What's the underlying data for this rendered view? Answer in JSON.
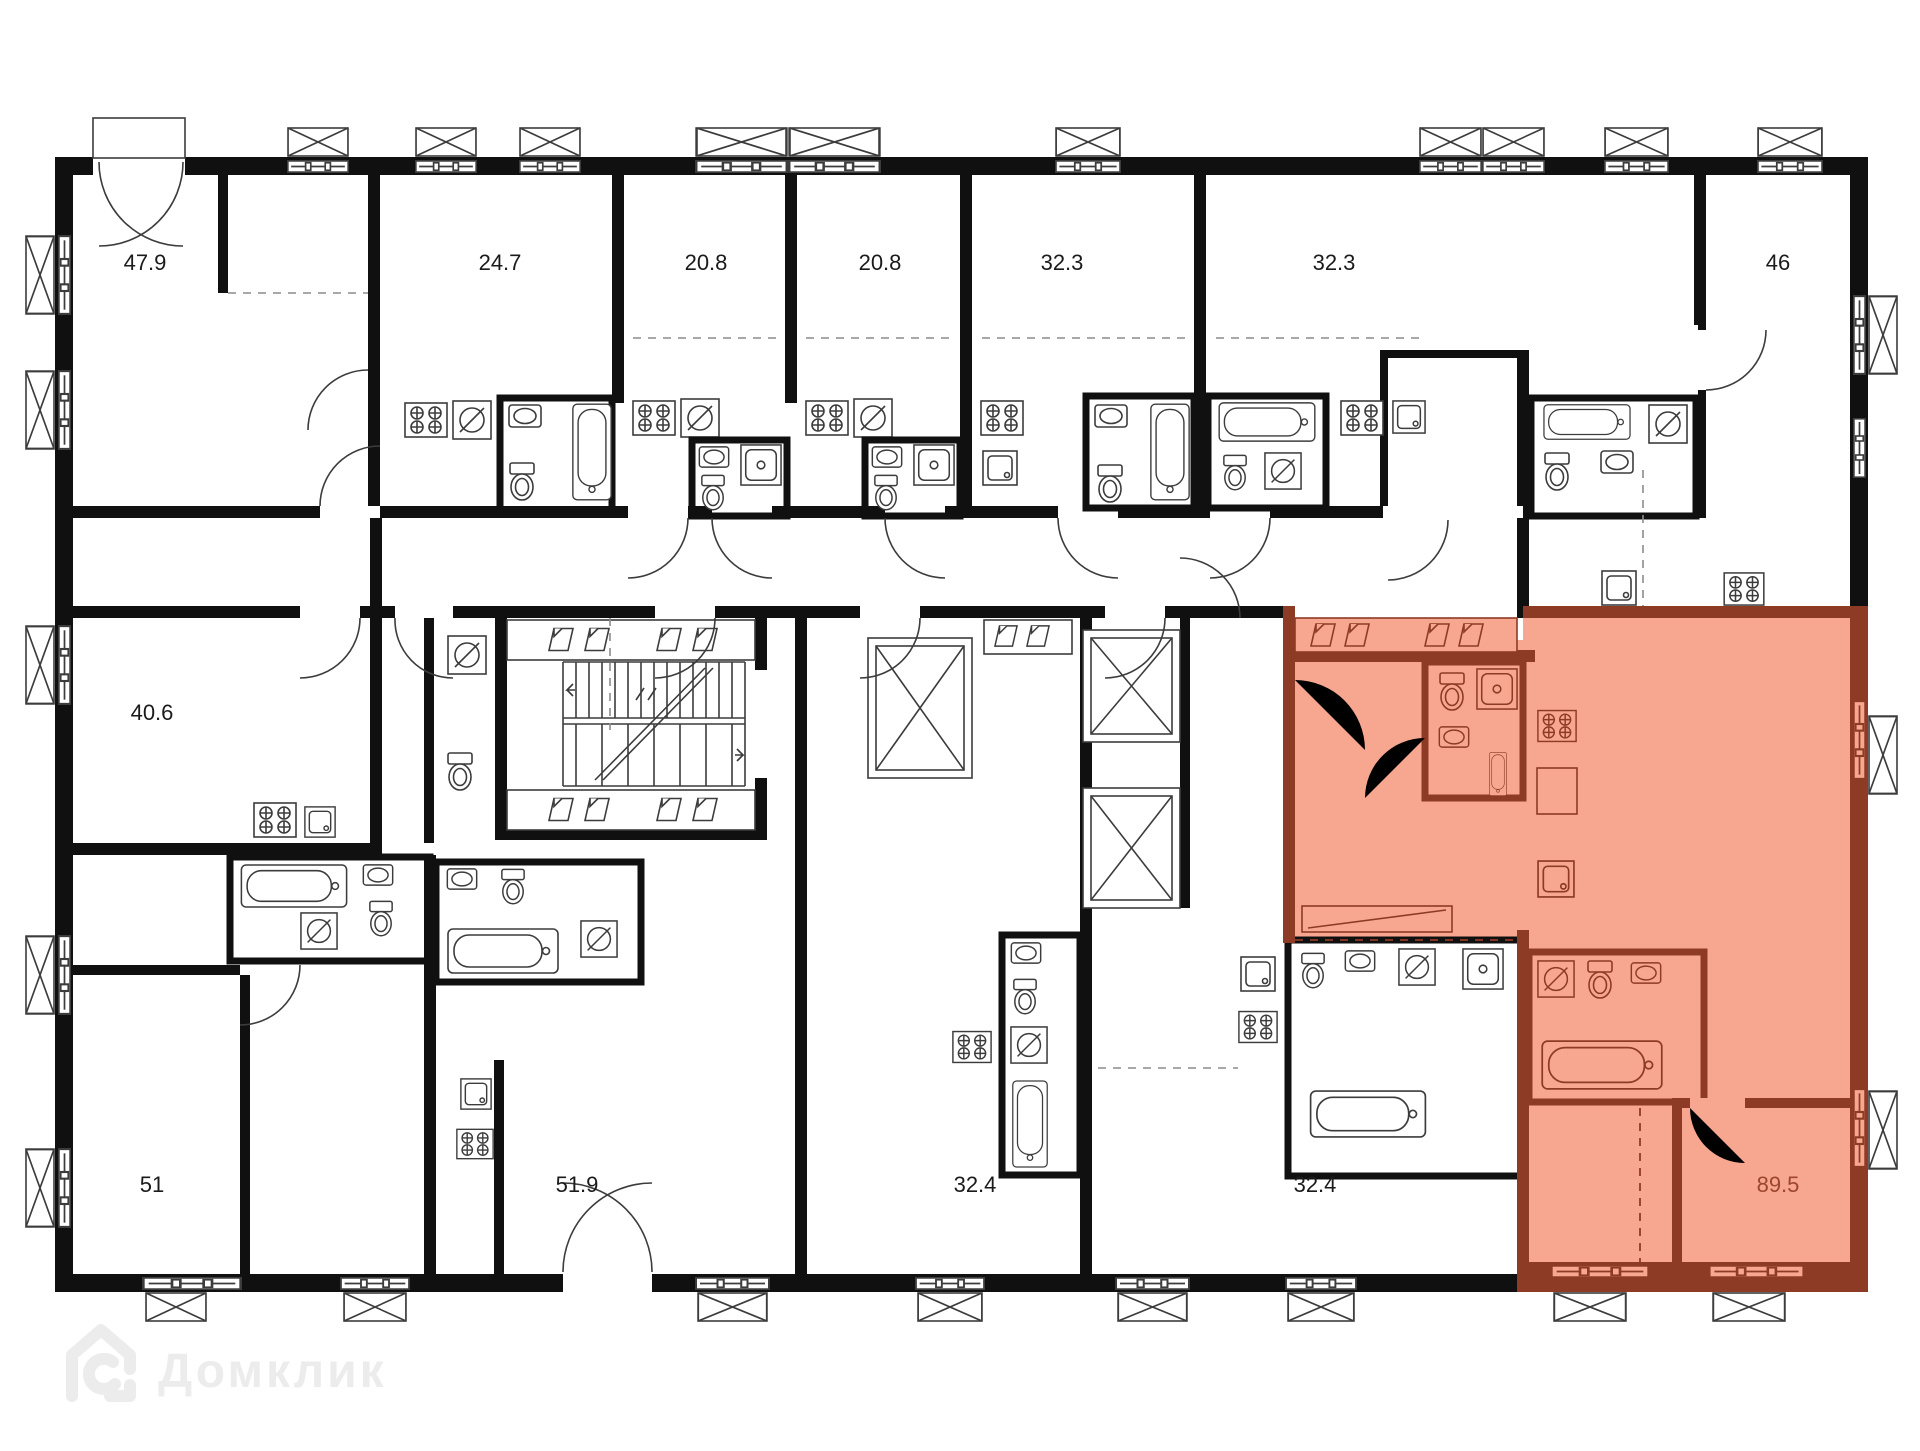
{
  "plan": {
    "wall_color": "#101010",
    "line_color": "#3c3c3c",
    "highlight": {
      "fill": "#f7a78f",
      "wall": "#8e3b25",
      "label_color": "#9c4630"
    },
    "units": [
      {
        "area": "47.9",
        "selected": false
      },
      {
        "area": "24.7",
        "selected": false
      },
      {
        "area": "20.8",
        "selected": false
      },
      {
        "area": "20.8",
        "selected": false
      },
      {
        "area": "32.3",
        "selected": false
      },
      {
        "area": "32.3",
        "selected": false
      },
      {
        "area": "46",
        "selected": false
      },
      {
        "area": "40.6",
        "selected": false
      },
      {
        "area": "51",
        "selected": false
      },
      {
        "area": "51.9",
        "selected": false
      },
      {
        "area": "32.4",
        "selected": false
      },
      {
        "area": "32.4",
        "selected": false
      },
      {
        "area": "89.5",
        "selected": true
      }
    ],
    "icons": [
      "balcony-icon",
      "window-icon",
      "elevator-icon",
      "stairs-icon",
      "bathtub-icon",
      "toilet-icon",
      "sink-icon",
      "washer-icon",
      "shower-icon",
      "cooktop-icon",
      "wardrobe-slot-icon",
      "door-arc-icon",
      "french-door-icon"
    ]
  },
  "watermark": {
    "text": "Домклик",
    "color": "#ececec"
  }
}
